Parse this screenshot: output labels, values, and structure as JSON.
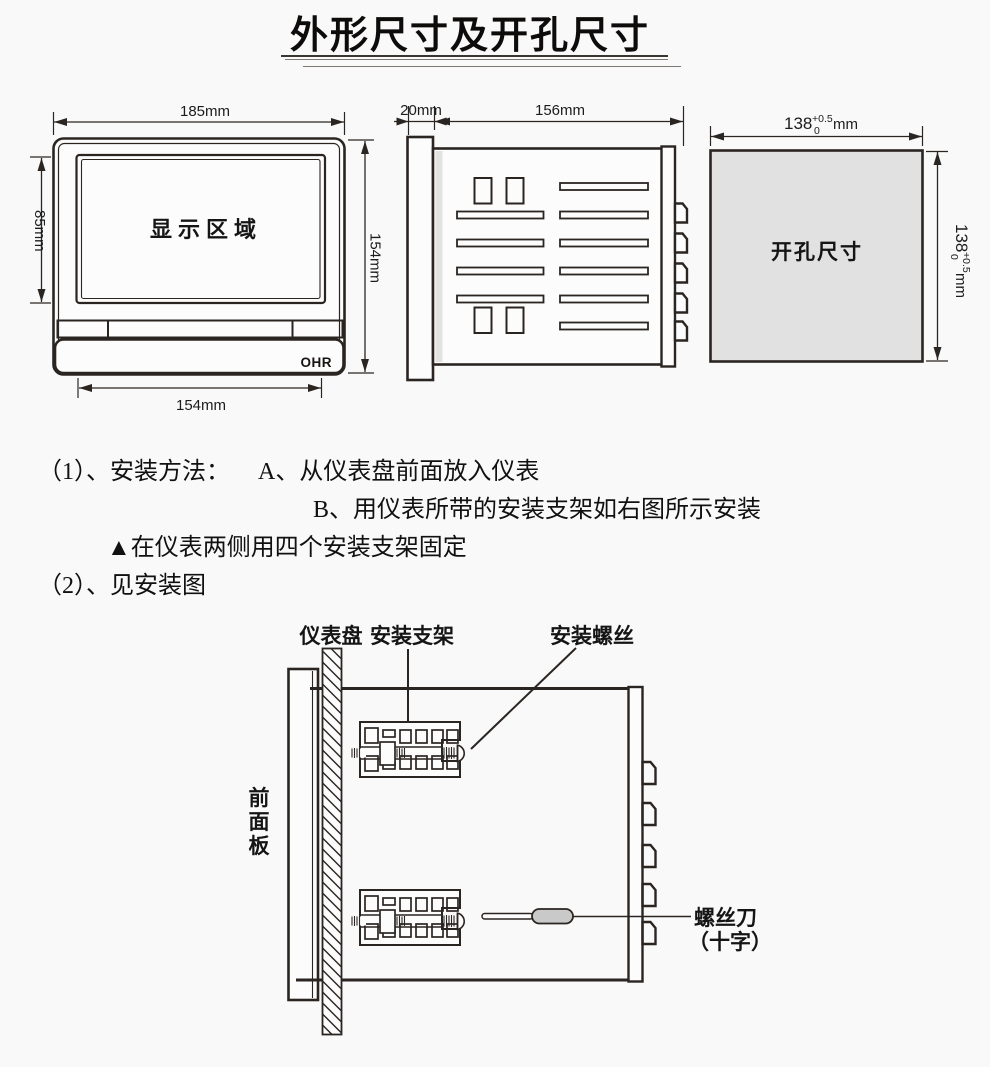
{
  "page": {
    "title": "外形尺寸及开孔尺寸"
  },
  "front_view": {
    "width_label": "185mm",
    "height_label": "154mm",
    "display_height_label": "85mm",
    "bottom_width_label": "154mm",
    "display_area_label": "显示区域",
    "brand": "OHR"
  },
  "side_view": {
    "bezel_depth_label": "20mm",
    "body_depth_label": "156mm"
  },
  "cutout_view": {
    "label": "开孔尺寸",
    "width_value": "138",
    "width_tol_upper": "+0.5",
    "width_tol_lower": "0",
    "width_unit": "mm",
    "height_value": "138",
    "height_tol_upper": "+0.5",
    "height_tol_lower": "0",
    "height_unit": "mm"
  },
  "instructions": {
    "item1_prefix": "（1）、安装方法：",
    "step_a": "A、从仪表盘前面放入仪表",
    "step_b": "B、用仪表所带的安装支架如右图所示安装",
    "note": "▲在仪表两侧用四个安装支架固定",
    "item2": "（2）、见安装图"
  },
  "install_figure": {
    "panel_label": "仪表盘",
    "bracket_label": "安装支架",
    "screw_label": "安装螺丝",
    "front_panel_chars": [
      "前",
      "面",
      "板"
    ],
    "screwdriver_label_line1": "螺丝刀",
    "screwdriver_label_line2": "（十字）"
  },
  "colors": {
    "line": "#2b2522",
    "text": "#151515",
    "cutout_fill": "#e1e1e1",
    "handle_fill": "#c9c9c9",
    "shadow_fill": "#e2e2e2",
    "background": "#f9f9f9"
  }
}
